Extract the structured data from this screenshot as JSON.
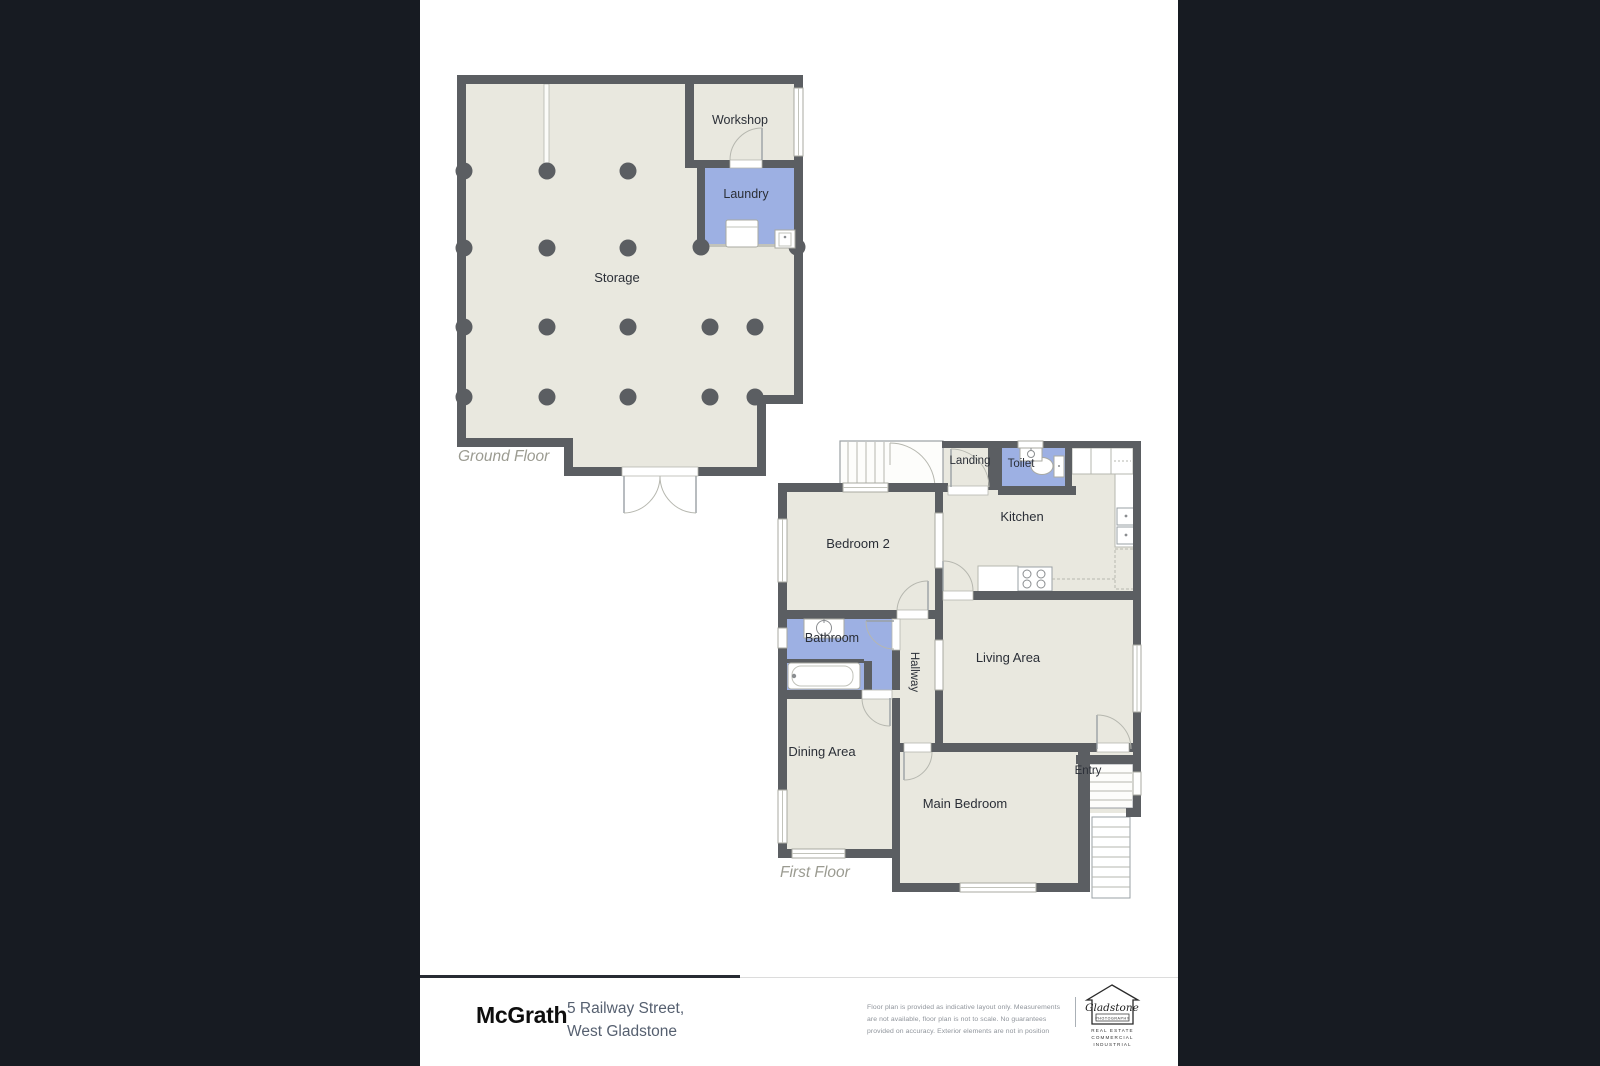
{
  "colors": {
    "background_bars": "#171b22",
    "page_surface": "#ffffff",
    "wall": "#5b5e62",
    "floor_fill": "#e9e8df",
    "wet_room_fill": "#9db0e3",
    "label_text": "#2b2f37",
    "caption_text": "#9b9b91"
  },
  "ground_floor": {
    "caption": "Ground Floor",
    "rooms": {
      "storage": "Storage",
      "workshop": "Workshop",
      "laundry": "Laundry"
    }
  },
  "first_floor": {
    "caption": "First Floor",
    "rooms": {
      "landing": "Landing",
      "toilet": "Toilet",
      "kitchen": "Kitchen",
      "bedroom2": "Bedroom 2",
      "bathroom": "Bathroom",
      "hallway": "Hallway",
      "living": "Living Area",
      "dining": "Dining Area",
      "main_bedroom": "Main Bedroom",
      "entry": "Entry"
    }
  },
  "footer": {
    "brand": "McGrath",
    "address_line1": "5 Railway Street,",
    "address_line2": "West Gladstone",
    "disclaimer_line1": "Floor plan is provided as indicative layout only. Measurements",
    "disclaimer_line2": "are not available, floor plan is not to scale. No guarantees",
    "disclaimer_line3": "provided on accuracy. Exterior elements are not in position",
    "photography_logo": {
      "name": "Gladstone",
      "subtitle": "PHOTOGRAPHY",
      "line1": "REAL ESTATE",
      "line2": "COMMERCIAL",
      "line3": "INDUSTRIAL"
    }
  }
}
